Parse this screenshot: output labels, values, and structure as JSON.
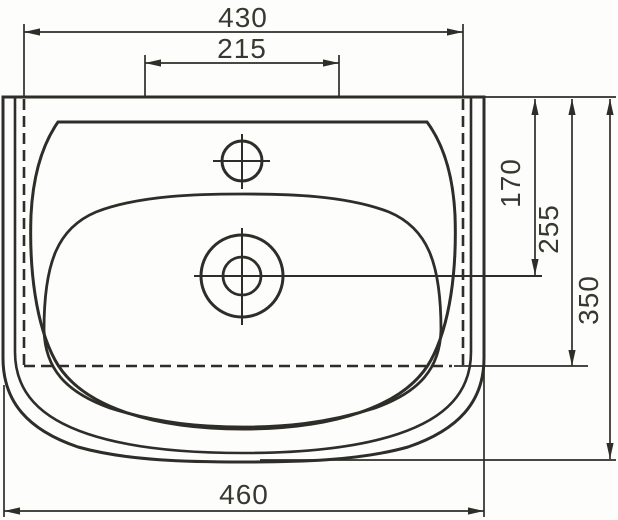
{
  "page": {
    "background_color": "#fdfdfc",
    "line_color": "#2f2d28",
    "text_color": "#39382f"
  },
  "drawing": {
    "kind": "technical dimension drawing",
    "subject": "washbasin top view",
    "dimensions": {
      "top_outer_width": "430",
      "top_inner_width": "215",
      "bottom_overall_width": "460",
      "right_inner_depth": "170",
      "right_middle_depth": "255",
      "right_overall_depth": "350"
    }
  }
}
